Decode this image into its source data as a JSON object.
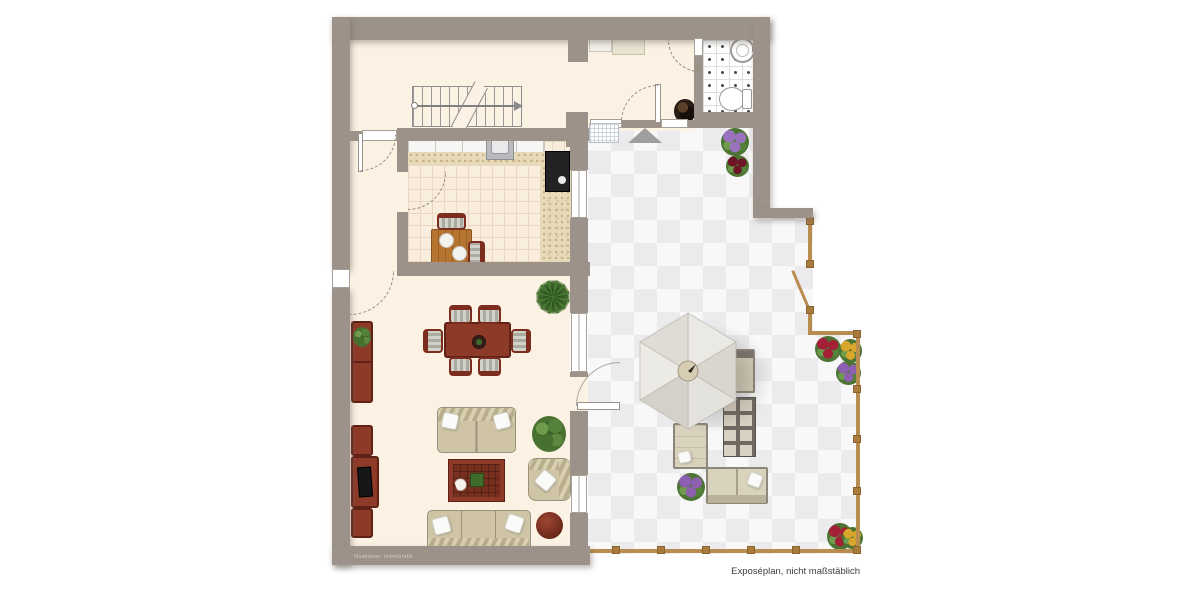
{
  "page": {
    "width": 1200,
    "height": 600,
    "background": "#ffffff"
  },
  "labels": {
    "disclaimer": "Exposéplan, nicht maßstäblich",
    "watermark": "Illustration: ImmoGrafik"
  },
  "colors": {
    "wall": "#9c9289",
    "interior_floor": "#fcf2e4",
    "kitchen_tile": "#f9edde",
    "kitchen_tile_line": "#ead7c0",
    "terrace_tile_light": "#f8f8f9",
    "terrace_tile_dark": "#ebebed",
    "bath_tile_dot": "#4a4a4e",
    "mahogany_furniture": "#8e3a29",
    "kitchen_table_wood": "#b5742f",
    "sofa_beige": "#cfc5a6",
    "outdoor_beige": "#d9d2bd",
    "parasol_gray": "#e9e7e2",
    "fence_tan": "#b98d4f",
    "plant_green": "#4a7a33",
    "flower_purple": "#8c5fb0",
    "flower_red": "#a32036",
    "flower_yellow": "#d8a62a",
    "door_arc": "#978c80",
    "entrance_marker": "#9e9e9e"
  },
  "plan": {
    "type": "residential floor plan with terrace",
    "rooms": [
      {
        "name": "stair-hall",
        "features": [
          "staircase-with-direction-arrow",
          "door-to-living-room"
        ]
      },
      {
        "name": "entry-hall",
        "features": [
          "wardrobe",
          "floor-plant",
          "door-to-terrace",
          "entrance-marker",
          "floor-grate"
        ]
      },
      {
        "name": "bathroom",
        "features": [
          "washbasin",
          "toilet",
          "dotted-tile-floor",
          "door-swing"
        ]
      },
      {
        "name": "kitchen",
        "features": [
          "counter-run",
          "sink-unit",
          "stove",
          "speckled-worktop",
          "small-wood-table",
          "two-chairs",
          "window-to-terrace"
        ]
      },
      {
        "name": "living-dining-room",
        "features": [
          "dining-table",
          "six-chairs",
          "sideboard-with-plant",
          "tv-lowboard",
          "two-seat-sofa",
          "three-seat-sofa",
          "armchair",
          "coffee-table",
          "round-ottoman",
          "palm-plant",
          "bush-plant",
          "two-windows",
          "terrace-door",
          "entrance-door"
        ]
      },
      {
        "name": "terrace",
        "features": [
          "checkerboard-tiles",
          "hexagonal-parasol",
          "lounger",
          "sun-lounger",
          "outdoor-sofa",
          "glass-grid-table",
          "garden-fence",
          "garden-gate",
          "flower-pots"
        ]
      }
    ]
  },
  "icons": {
    "door-swing-icon": "dashed quarter-circle arc",
    "entrance-marker-icon": "gray triangle pointing to entry door",
    "stairs-icon": "stepped treads with walk line, circle start, arrow end",
    "window-icon": "white bar with frame lines",
    "parasol-icon": "hexagonal umbrella canopy with center hub",
    "washbasin-icon": "circle basin with tap",
    "toilet-icon": "oval bowl with cistern",
    "stove-icon": "black cooktop",
    "sink-unit-icon": "gray square with inner basin",
    "radiator-grate-icon": "fine-grid white rectangle",
    "fence-icon": "tan rail with square posts"
  }
}
